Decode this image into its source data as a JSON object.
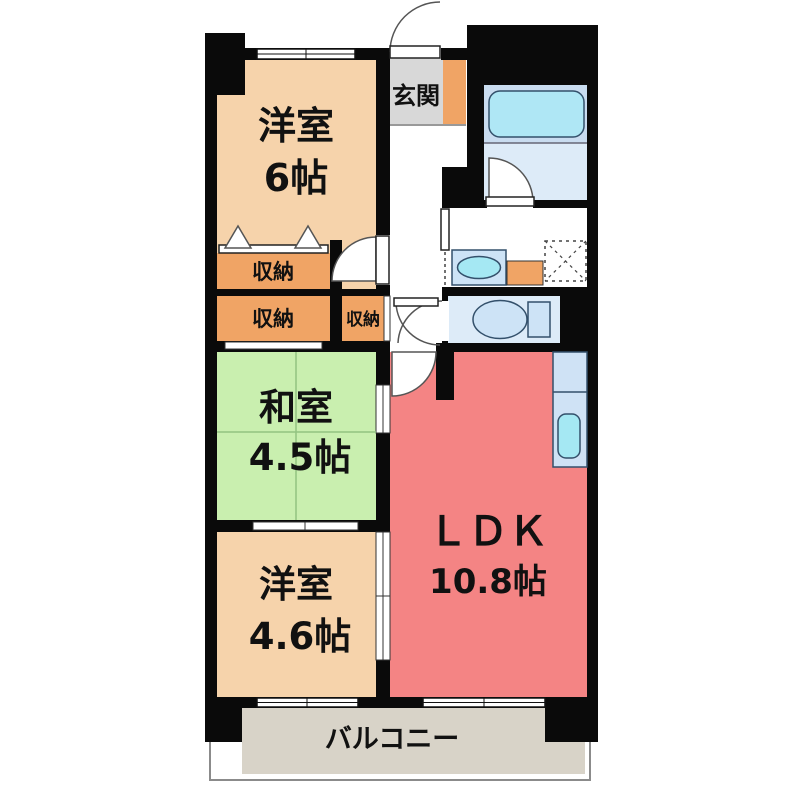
{
  "rooms": {
    "western6": {
      "label": "洋室",
      "area": "6帖"
    },
    "entrance": {
      "label": "玄関"
    },
    "storage": {
      "label": "収納"
    },
    "japanese": {
      "label": "和室",
      "area": "4.5帖"
    },
    "western46": {
      "label": "洋室",
      "area": "4.6帖"
    },
    "ldk": {
      "label": "ＬＤＫ",
      "area": "10.8帖"
    },
    "balcony": {
      "label": "バルコニー"
    }
  },
  "colors": {
    "wall": "#0a0a0a",
    "western_room": "#f6d3ab",
    "japanese_room": "#c9efaf",
    "ldk_room": "#f48484",
    "storage_orange": "#f0a465",
    "entrance_gray": "#d8d8d8",
    "balcony_gray": "#d8d3c8",
    "bath_upper": "#c9dcf0",
    "bath_lower": "#ddebf8",
    "bathtub": "#afe7f5",
    "fixture_blue": "#cde3f6",
    "sink_cyan": "#a5e8f3",
    "counter_blue": "#cfe2f5"
  }
}
